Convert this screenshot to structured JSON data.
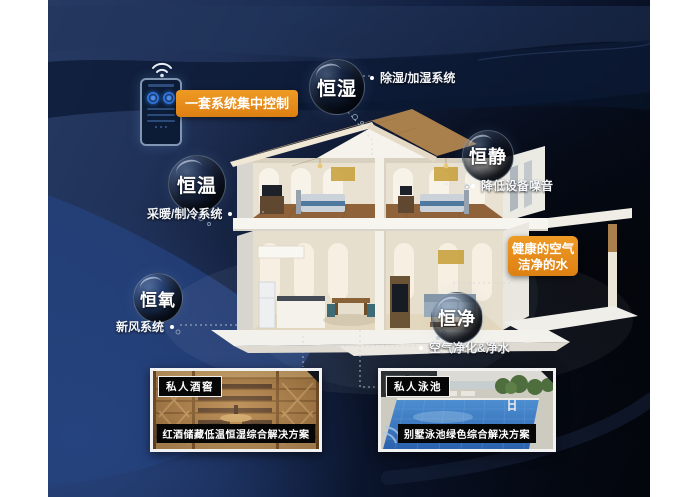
{
  "control_label": "一套系统集中控制",
  "benefit_box": {
    "line1": "健康的空气",
    "line2": "洁净的水"
  },
  "bubbles": [
    {
      "label": "恒湿",
      "sub": "除湿/加湿系统"
    },
    {
      "label": "恒静",
      "sub": "降低设备噪音"
    },
    {
      "label": "恒温",
      "sub": "采暖/制冷系统"
    },
    {
      "label": "恒氧",
      "sub": "新风系统"
    },
    {
      "label": "恒净",
      "sub": "空气净化&净水"
    }
  ],
  "cards": [
    {
      "tag": "私人酒窖",
      "caption": "红酒储藏低温恒湿综合解决方案"
    },
    {
      "tag": "私人泳池",
      "caption": "别墅泳池绿色综合解决方案"
    }
  ],
  "icons": {
    "wifi": "wifi-icon",
    "phone": "smart-control-phone"
  },
  "colors": {
    "accent_orange": "#e08519",
    "background_navy": "#1c2c50",
    "background_blue": "#26437f",
    "background_black": "#05080f",
    "caption_bg": "#060606"
  }
}
